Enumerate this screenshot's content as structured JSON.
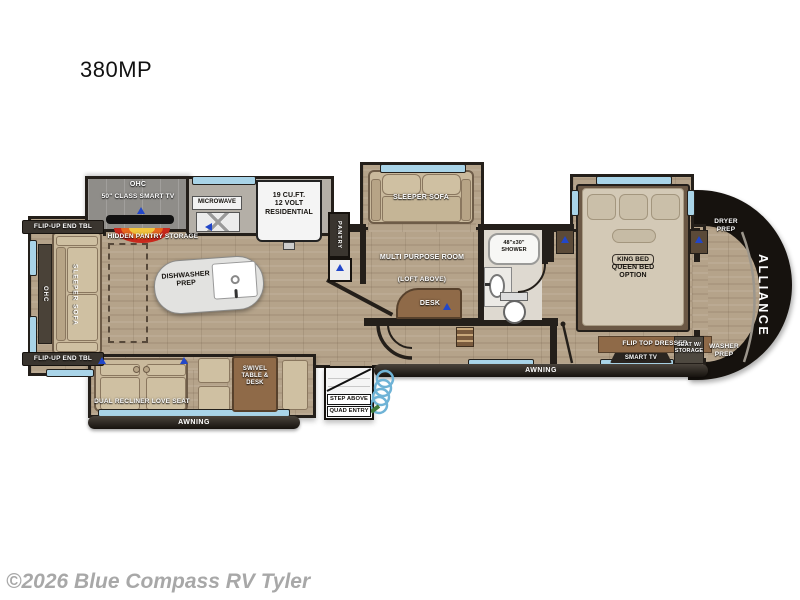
{
  "page": {
    "title": "380MP",
    "watermark": "©2026 Blue Compass RV Tyler"
  },
  "fp": {
    "brand": "ALLIANCE",
    "rear": {
      "flip_top": "FLIP-UP END TBL",
      "flip_bottom": "FLIP-UP END TBL",
      "ohc": "OHC",
      "sofa": "SLEEPER SOFA"
    },
    "ent": {
      "ohc": "OHC",
      "tv": "50\" CLASS SMART TV",
      "hidden": "HIDDEN PANTRY STORAGE"
    },
    "kitchen": {
      "microwave": "MICROWAVE",
      "fridge": "19 CU.FT.\n12 VOLT\nRESIDENTIAL",
      "pantry": "PANTRY",
      "island": "DISHWASHER\nPREP"
    },
    "mpr": {
      "sofa": "SLEEPER SOFA",
      "room": "MULTI PURPOSE ROOM",
      "loft": "(LOFT ABOVE)",
      "desk": "DESK"
    },
    "bath": {
      "shower": "48\"x30\"\nSHOWER"
    },
    "bed": {
      "king": "KING BED",
      "queen": "QUEEN BED\nOPTION",
      "dresser": "FLIP TOP DRESSER",
      "tv": "SMART TV",
      "seat": "SEAT W/\nSTORAGE"
    },
    "front": {
      "dryer": "DRYER\nPREP",
      "washer": "WASHER\nPREP"
    },
    "door": {
      "recliner": "DUAL RECLINER LOVE SEAT",
      "swivel": "SWIVEL\nTABLE &\nDESK",
      "awning_left": "AWNING",
      "awning_right": "AWNING",
      "step": "STEP ABOVE",
      "entry": "QUAD ENTRY"
    }
  },
  "colors": {
    "wall": "#241f1a",
    "floor": "#b5a38a",
    "window": "#a9d4e8",
    "marker_blue": "#2247c9",
    "front_cap": "#16120e",
    "furniture_wood": "#8f6a48",
    "sofa_tan": "#c9b99c",
    "fireplace_red": "#c9281c",
    "watermark_gray": "#a8a8a8"
  }
}
